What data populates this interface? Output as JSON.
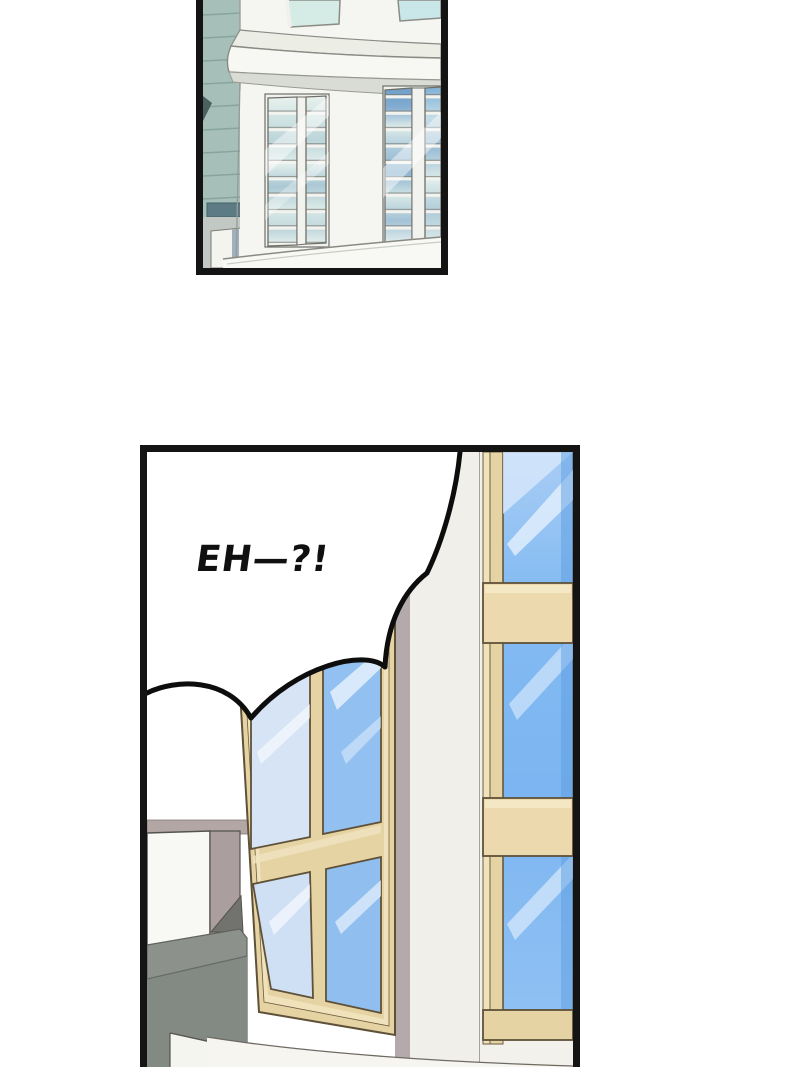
{
  "comic": {
    "speech_bubble": {
      "text": "EH—?!"
    },
    "panels": [
      {
        "id": "top-panel"
      },
      {
        "id": "bottom-panel"
      }
    ],
    "colors": {
      "panel_border": "#141414",
      "bubble_fill": "#ffffff",
      "bubble_outline": "#0d0d0d",
      "teal_siding": "#a6c0b9",
      "teal_siding_dark": "#5d7b84",
      "tower_white": "#f5f5f1",
      "tower_glass_teal": "#d5ece6",
      "frame_tan": "#e6d3a4",
      "frame_tan_light": "#f0e2bb",
      "frame_outline": "#5f5138",
      "glass_blue": "#84bbf2",
      "glass_blue_light": "#d6e4f5",
      "wall_white": "#f1efe9",
      "shadow_mauve": "#b4a9ab",
      "gray_dark": "#8c918b"
    }
  }
}
